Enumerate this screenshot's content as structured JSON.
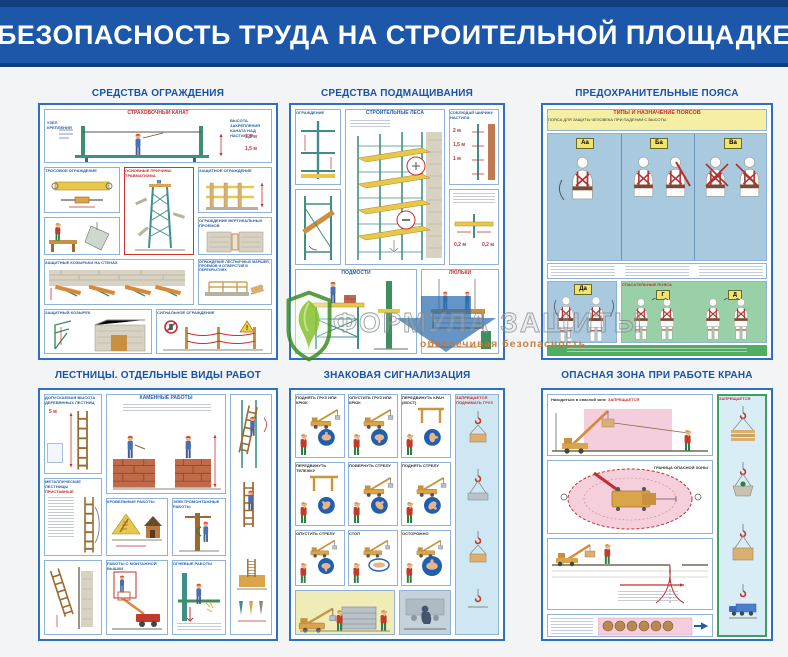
{
  "header": {
    "title": "БЕЗОПАСНОСТЬ ТРУДА НА СТРОИТЕЛЬНОЙ ПЛОЩАДКЕ"
  },
  "watermark": {
    "brand": "ФОРМУЛА ЗАЩИТЫ",
    "tagline": "обеспечивая безопасность"
  },
  "posters": {
    "fencing": {
      "title": "СРЕДСТВА ОГРАЖДЕНИЯ",
      "safety_rope": "СТРАХОВОЧНЫЙ КАНАТ",
      "attachment_node": "УЗЕЛ КРЕПЛЕНИЯ",
      "rope_height_note": "ВЫСОТА ЗАКРЕПЛЕНИЯ КАНАТА НАД НАСТИЛОМ",
      "dim_12": "1,2 м",
      "dim_15": "1,5 м",
      "cable_fence": "ТРОСОВОЕ ОГРАЖДЕНИЕ",
      "injury_causes": "ОСНОВНЫЕ ПРИЧИНЫ ТРАВМАТИЗМА",
      "protective_fence": "ЗАЩИТНОЕ ОГРАЖДЕНИЕ",
      "vertical_openings": "ОГРАЖДЕНИЕ ВЕРТИКАЛЬНЫХ ПРОЕМОВ",
      "wall_canopies": "ЗАЩИТНЫЕ КОЗЫРЬКИ НА СТЕНАХ",
      "stair_openings": "ОГРАЖДЕНИЕ ЛЕСТНИЧНЫХ МАРШЕЙ, ПРОЕМОВ И ОТВЕРСТИЙ В ПЕРЕКРЫТИЯХ",
      "protective_canopy": "ЗАЩИТНЫЙ КОЗЫРЕК",
      "signal_fence": "СИГНАЛЬНОЕ ОГРАЖДЕНИЕ"
    },
    "scaffolding": {
      "title": "СРЕДСТВА ПОДМАЩИВАНИЯ",
      "fencing": "ОГРАЖДЕНИЕ",
      "scaffolds": "СТРОИТЕЛЬНЫЕ ЛЕСА",
      "deck_width": "СОБЛЮДАЙ ШИРИНУ НАСТИЛА",
      "dim_2": "2 м",
      "dim_15": "1,5 м",
      "dim_1": "1 м",
      "dim_02": "0,2 м",
      "trestles": "ПОДМОСТИ",
      "cradles": "ЛЮЛЬКИ"
    },
    "belts": {
      "title": "ПРЕДОХРАНИТЕЛЬНЫЕ ПОЯСА",
      "types_header": "ТИПЫ И НАЗНАЧЕНИЕ ПОЯСОВ",
      "types_sub": "ПОЯСА ДЛЯ ЗАЩИТЫ ЧЕЛОВЕКА ПРИ ПАДЕНИИ С ВЫСОТЫ",
      "type_aa": "Аа",
      "type_ba": "Ба",
      "type_va": "Ва",
      "type_da": "Да",
      "type_g": "Г",
      "type_d": "Д",
      "rescue": "СПАСАТЕЛЬНЫЕ ПОЯСА"
    },
    "ladders": {
      "title": "ЛЕСТНИЦЫ. ОТДЕЛЬНЫЕ ВИДЫ РАБОТ",
      "wood_height": "ДОПУСКАЕМАЯ ВЫСОТА ДЕРЕВЯННЫХ ЛЕСТНИЦ",
      "dim_5": "5 м",
      "masonry": "КАМЕННЫЕ РАБОТЫ",
      "metal_ladders": "МЕТАЛЛИЧЕСКИЕ ЛЕСТНИЦЫ",
      "leaning": "ПРИСТАВНЫЕ",
      "roofing": "КРОВЕЛЬНЫЕ РАБОТЫ",
      "electrical": "ЭЛЕКТРОМОНТАЖНЫЕ РАБОТЫ",
      "tower_work": "РАБОТЫ С МОНТАЖНОЙ ВЫШКИ",
      "hot_work": "ОГНЕВЫЕ РАБОТЫ"
    },
    "signals": {
      "title": "ЗНАКОВАЯ СИГНАЛИЗАЦИЯ",
      "gestures": [
        "ПОДНЯТЬ ГРУЗ ИЛИ КРЮК",
        "ОПУСТИТЬ ГРУЗ ИЛИ КРЮК",
        "ПЕРЕДВИНУТЬ КРАН (МОСТ)",
        "ПЕРЕДВИНУТЬ ТЕЛЕЖКУ",
        "ПОВЕРНУТЬ СТРЕЛУ",
        "ПОДНЯТЬ СТРЕЛУ",
        "ОПУСТИТЬ СТРЕЛУ",
        "СТОП",
        "ОСТОРОЖНО"
      ],
      "forbidden_note": "ЗАПРЕЩАЕТСЯ ПОДНИМАТЬ ГРУЗ"
    },
    "crane_zone": {
      "title": "ОПАСНАЯ ЗОНА ПРИ РАБОТЕ КРАНА",
      "note_prefix": "Находиться в опасной зоне",
      "forbidden": "ЗАПРЕЩАЕТСЯ",
      "zone_border": "ГРАНИЦА ОПАСНОЙ ЗОНЫ"
    }
  }
}
